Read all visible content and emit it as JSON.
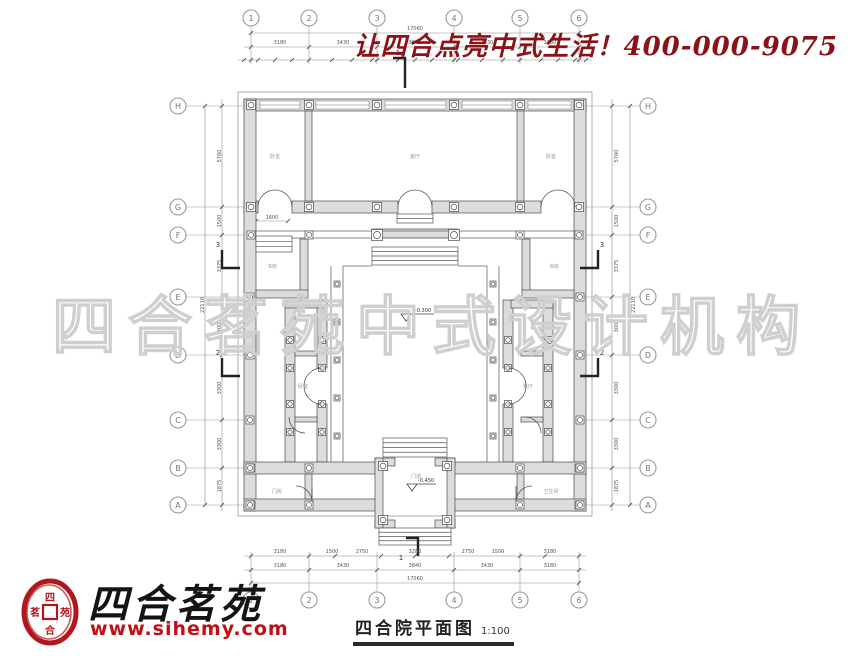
{
  "banner": {
    "text": "让四合点亮中式生活！400-000-9075",
    "color": "#8b1216"
  },
  "watermark": {
    "text": "四合茗苑中式设计机构",
    "color": "#cfcfcf"
  },
  "logo": {
    "name": "四合茗苑",
    "url": "www.sihemy.com",
    "seal_top": "四",
    "seal_left": "茗",
    "seal_right": "苑",
    "seal_bottom": "合",
    "seal_color": "#b3161d",
    "url_color": "#c01015"
  },
  "caption": {
    "title": "四合院平面图",
    "scale": "1:100"
  },
  "axes": {
    "top": [
      "1",
      "2",
      "3",
      "4",
      "5",
      "6"
    ],
    "bottom": [
      "1",
      "2",
      "3",
      "4",
      "5",
      "6"
    ],
    "left": [
      "H",
      "G",
      "F",
      "E",
      "D",
      "C",
      "B",
      "A"
    ],
    "right": [
      "H",
      "G",
      "F",
      "E",
      "D",
      "C",
      "B",
      "A"
    ]
  },
  "dims": {
    "top_total": "17060",
    "top_major": [
      "3180",
      "3430",
      "3840",
      "3430",
      "3180"
    ],
    "bottom_detail": [
      "3180",
      "1500",
      "2750",
      "3280",
      "2750",
      "1500",
      "3180"
    ],
    "bottom_major": [
      "3180",
      "3430",
      "3840",
      "3430",
      "3180"
    ],
    "bottom_total": "17060",
    "left_detail": [
      "5760",
      "1500",
      "3375",
      "3000",
      "3300",
      "3300",
      "1875"
    ],
    "left_total": "22110",
    "right_detail": [
      "5760",
      "1500",
      "3375",
      "3000",
      "3300",
      "3300",
      "1875"
    ],
    "right_total": "22110",
    "inner_terrace": "1600"
  },
  "plan": {
    "rooms": {
      "north_left": "卧室",
      "north_center": "客厅",
      "north_right": "卧室",
      "side_left": "书房",
      "side_right": "书房",
      "west_wing": "卧室",
      "east_wing": "餐厅",
      "south_left": "门房",
      "south_right": "卫生间",
      "gate": "门道"
    },
    "elevations": {
      "courtyard": "-0.300",
      "gate": "-0.450"
    },
    "sections": {
      "s1": "1",
      "s2": "2",
      "s3": "3"
    }
  }
}
